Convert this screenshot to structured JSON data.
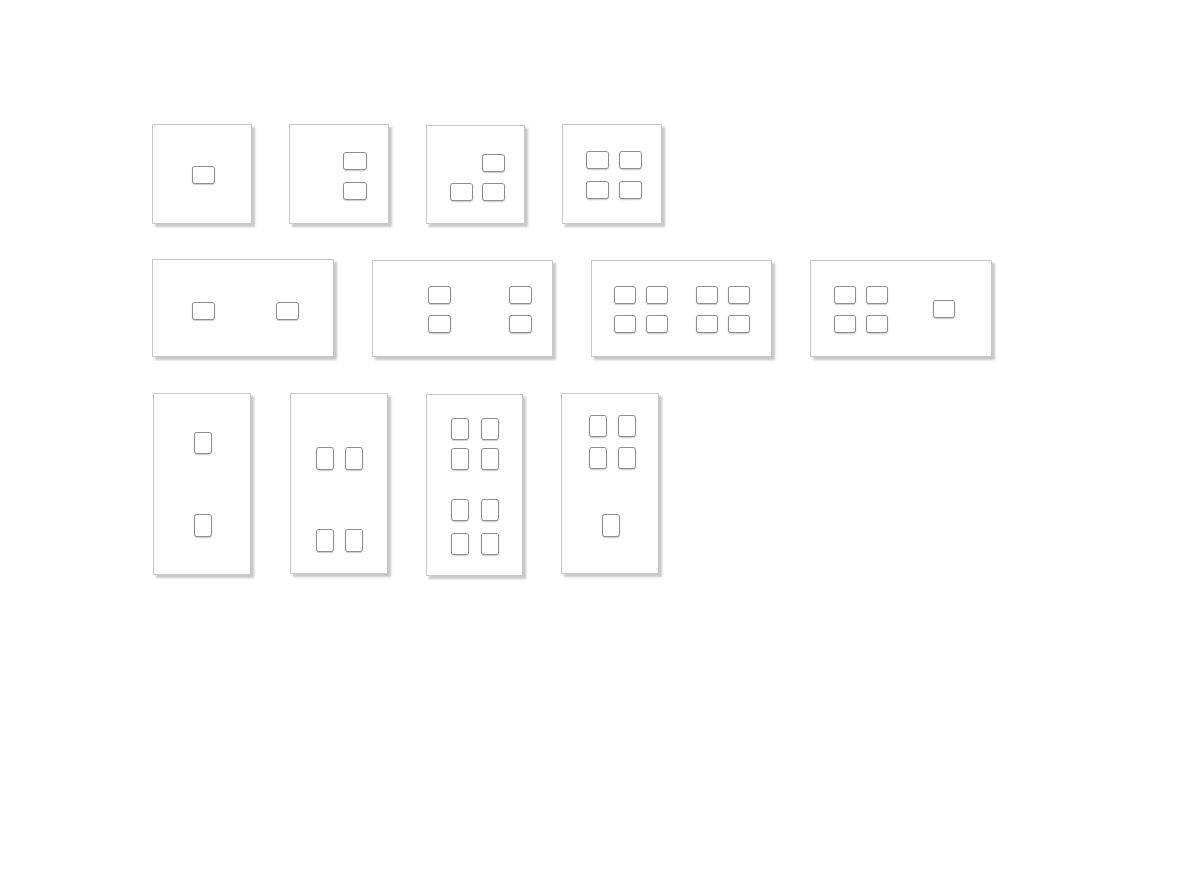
{
  "page": {
    "width": 1199,
    "height": 884,
    "background": "#ffffff"
  },
  "styles": {
    "plate_fill": "#ffffff",
    "plate_border": "#c8c8c8",
    "plate_shadow": "rgba(130,130,130,0.45)",
    "button_fill": "#ffffff",
    "button_border": "#8e8e8e",
    "button_shadow": "rgba(180,180,180,0.7)"
  },
  "gallery": {
    "description": "Grid of keypad wall-plate layout drawings: row 1 square 1-gang plates (1,2,3,4 buttons), row 2 wide 2-gang plates (2,4,8,5 buttons), row 3 tall 2-gang plates (2,4,8,5 buttons)",
    "rows": 3,
    "plates_per_row": 4
  },
  "plates": [
    {
      "name": "plate-square-1button",
      "orientation": "square",
      "button_count": 1,
      "x": 152,
      "y": 124,
      "w": 100,
      "h": 100,
      "buttons": [
        {
          "x": 39,
          "y": 41,
          "w": 23,
          "h": 18
        }
      ]
    },
    {
      "name": "plate-square-2button",
      "orientation": "square",
      "button_count": 2,
      "x": 289,
      "y": 124,
      "w": 100,
      "h": 100,
      "buttons": [
        {
          "x": 53,
          "y": 27,
          "w": 24,
          "h": 18
        },
        {
          "x": 53,
          "y": 57,
          "w": 24,
          "h": 18
        }
      ]
    },
    {
      "name": "plate-square-3button",
      "orientation": "square",
      "button_count": 3,
      "x": 426,
      "y": 125,
      "w": 99,
      "h": 99,
      "buttons": [
        {
          "x": 55,
          "y": 28,
          "w": 23,
          "h": 18
        },
        {
          "x": 23,
          "y": 57,
          "w": 23,
          "h": 18
        },
        {
          "x": 55,
          "y": 57,
          "w": 23,
          "h": 18
        }
      ]
    },
    {
      "name": "plate-square-4button",
      "orientation": "square",
      "button_count": 4,
      "x": 562,
      "y": 124,
      "w": 100,
      "h": 100,
      "buttons": [
        {
          "x": 23,
          "y": 26,
          "w": 23,
          "h": 18
        },
        {
          "x": 56,
          "y": 26,
          "w": 23,
          "h": 18
        },
        {
          "x": 23,
          "y": 56,
          "w": 23,
          "h": 18
        },
        {
          "x": 56,
          "y": 56,
          "w": 23,
          "h": 18
        }
      ]
    },
    {
      "name": "plate-wide-2button",
      "orientation": "horizontal",
      "button_count": 2,
      "x": 152,
      "y": 259,
      "w": 182,
      "h": 98,
      "buttons": [
        {
          "x": 39,
          "y": 42,
          "w": 23,
          "h": 18
        },
        {
          "x": 123,
          "y": 42,
          "w": 23,
          "h": 18
        }
      ]
    },
    {
      "name": "plate-wide-4button",
      "orientation": "horizontal",
      "button_count": 4,
      "x": 372,
      "y": 260,
      "w": 181,
      "h": 97,
      "buttons": [
        {
          "x": 55,
          "y": 25,
          "w": 23,
          "h": 18
        },
        {
          "x": 136,
          "y": 25,
          "w": 23,
          "h": 18
        },
        {
          "x": 55,
          "y": 54,
          "w": 23,
          "h": 18
        },
        {
          "x": 136,
          "y": 54,
          "w": 23,
          "h": 18
        }
      ]
    },
    {
      "name": "plate-wide-8button",
      "orientation": "horizontal",
      "button_count": 8,
      "x": 591,
      "y": 260,
      "w": 181,
      "h": 97,
      "buttons": [
        {
          "x": 22,
          "y": 25,
          "w": 22,
          "h": 18
        },
        {
          "x": 54,
          "y": 25,
          "w": 22,
          "h": 18
        },
        {
          "x": 104,
          "y": 25,
          "w": 22,
          "h": 18
        },
        {
          "x": 136,
          "y": 25,
          "w": 22,
          "h": 18
        },
        {
          "x": 22,
          "y": 54,
          "w": 22,
          "h": 18
        },
        {
          "x": 54,
          "y": 54,
          "w": 22,
          "h": 18
        },
        {
          "x": 104,
          "y": 54,
          "w": 22,
          "h": 18
        },
        {
          "x": 136,
          "y": 54,
          "w": 22,
          "h": 18
        }
      ]
    },
    {
      "name": "plate-wide-5button",
      "orientation": "horizontal",
      "button_count": 5,
      "x": 810,
      "y": 260,
      "w": 182,
      "h": 97,
      "buttons": [
        {
          "x": 23,
          "y": 25,
          "w": 22,
          "h": 18
        },
        {
          "x": 55,
          "y": 25,
          "w": 22,
          "h": 18
        },
        {
          "x": 23,
          "y": 54,
          "w": 22,
          "h": 18
        },
        {
          "x": 55,
          "y": 54,
          "w": 22,
          "h": 18
        },
        {
          "x": 122,
          "y": 39,
          "w": 22,
          "h": 18
        }
      ]
    },
    {
      "name": "plate-tall-2button",
      "orientation": "vertical",
      "button_count": 2,
      "x": 153,
      "y": 393,
      "w": 98,
      "h": 182,
      "buttons": [
        {
          "x": 40,
          "y": 38,
          "w": 18,
          "h": 22
        },
        {
          "x": 40,
          "y": 120,
          "w": 18,
          "h": 23
        }
      ]
    },
    {
      "name": "plate-tall-4button",
      "orientation": "vertical",
      "button_count": 4,
      "x": 290,
      "y": 393,
      "w": 98,
      "h": 181,
      "buttons": [
        {
          "x": 25,
          "y": 53,
          "w": 18,
          "h": 23
        },
        {
          "x": 54,
          "y": 53,
          "w": 18,
          "h": 23
        },
        {
          "x": 25,
          "y": 135,
          "w": 18,
          "h": 23
        },
        {
          "x": 54,
          "y": 135,
          "w": 18,
          "h": 23
        }
      ]
    },
    {
      "name": "plate-tall-8button",
      "orientation": "vertical",
      "button_count": 8,
      "x": 426,
      "y": 394,
      "w": 97,
      "h": 182,
      "buttons": [
        {
          "x": 24,
          "y": 23,
          "w": 18,
          "h": 22
        },
        {
          "x": 54,
          "y": 23,
          "w": 18,
          "h": 22
        },
        {
          "x": 24,
          "y": 53,
          "w": 18,
          "h": 22
        },
        {
          "x": 54,
          "y": 53,
          "w": 18,
          "h": 22
        },
        {
          "x": 24,
          "y": 104,
          "w": 18,
          "h": 22
        },
        {
          "x": 54,
          "y": 104,
          "w": 18,
          "h": 22
        },
        {
          "x": 24,
          "y": 138,
          "w": 18,
          "h": 22
        },
        {
          "x": 54,
          "y": 138,
          "w": 18,
          "h": 22
        }
      ]
    },
    {
      "name": "plate-tall-5button",
      "orientation": "vertical",
      "button_count": 5,
      "x": 561,
      "y": 393,
      "w": 98,
      "h": 181,
      "buttons": [
        {
          "x": 27,
          "y": 21,
          "w": 18,
          "h": 22
        },
        {
          "x": 56,
          "y": 21,
          "w": 18,
          "h": 22
        },
        {
          "x": 27,
          "y": 53,
          "w": 18,
          "h": 22
        },
        {
          "x": 56,
          "y": 53,
          "w": 18,
          "h": 22
        },
        {
          "x": 40,
          "y": 120,
          "w": 18,
          "h": 23
        }
      ]
    }
  ]
}
